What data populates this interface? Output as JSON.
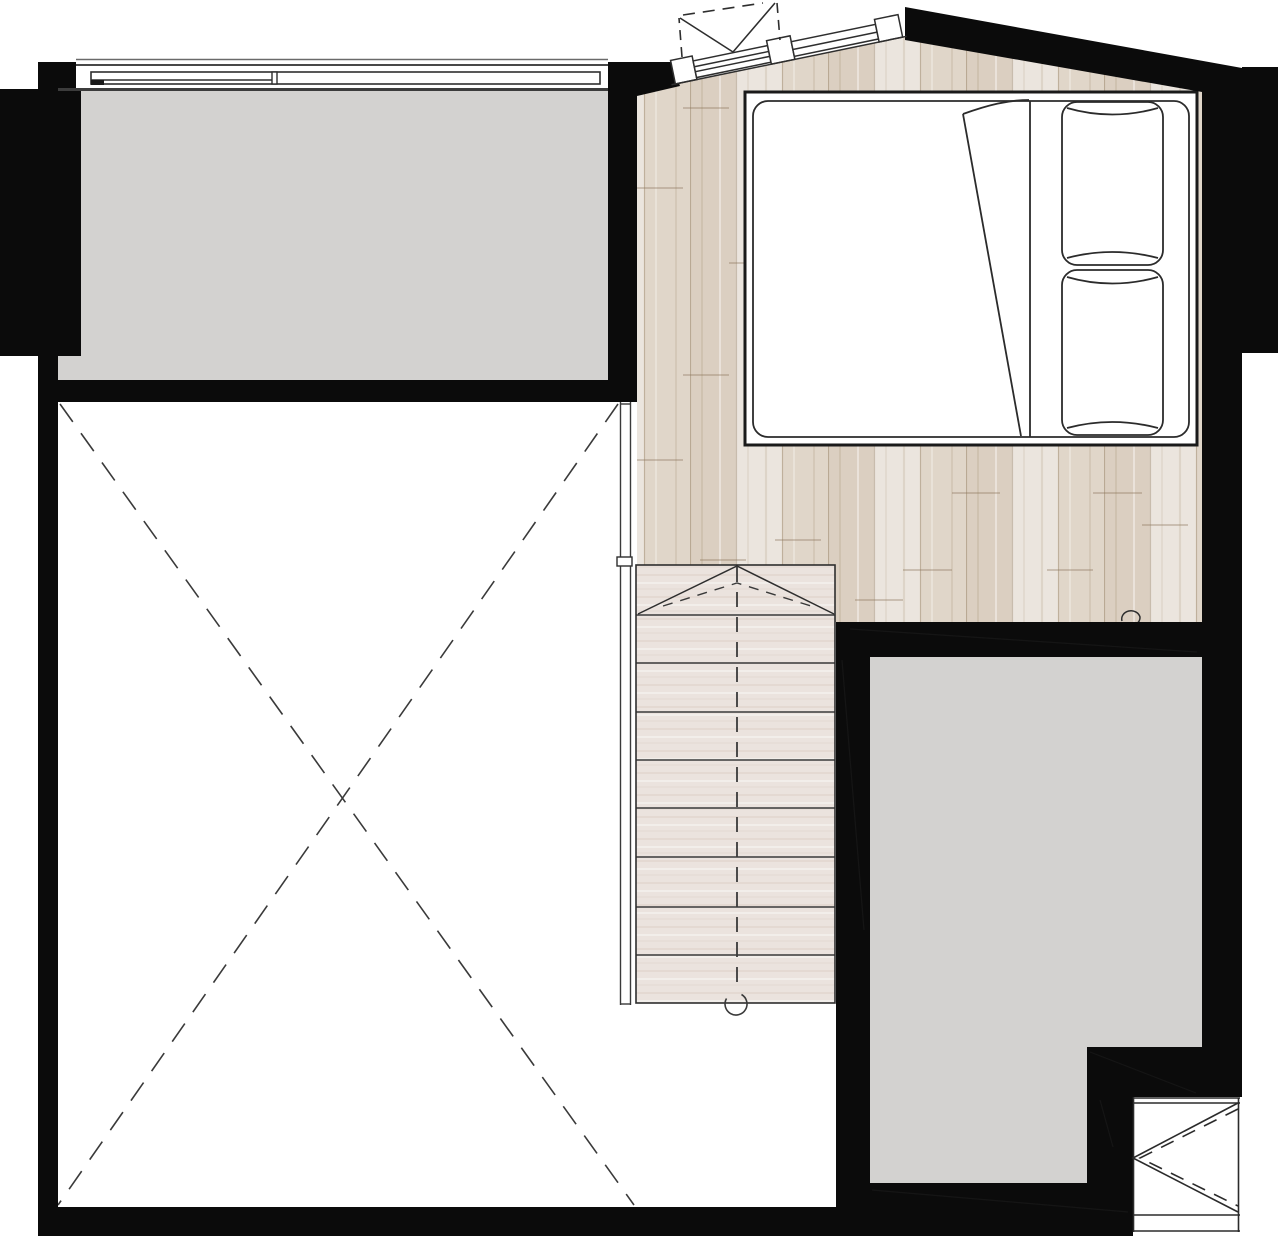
{
  "canvas": {
    "width": 1280,
    "height": 1238
  },
  "colors": {
    "background": "#ffffff",
    "wall": "#0b0b0b",
    "room_gray": "#d3d2d0",
    "wood_base": "#e0d7cc",
    "wood_dark_plank": "#d5c9ba",
    "wood_light_plank": "#eae3da",
    "stair_base": "#ebe3de",
    "stair_grain": "#dcd1ca",
    "line_dark": "#2e2e2e",
    "line_faint": "#6a6a6a"
  },
  "plan": {
    "type": "floor-plan-drawing",
    "rooms_visible": 4,
    "stairs": {
      "tread_lines": 8,
      "has_direction_dashed_centerline": true,
      "has_start_circle": true
    },
    "bed": {
      "pillows": 2,
      "has_folded_duvet_corner": true
    },
    "windows": {
      "top_left_window_panes": 2,
      "slanted_casement_window": true,
      "bottom_right_opening_with_swing_symbol": true
    },
    "void_area": {
      "marked_with_dashed_x": true
    }
  }
}
